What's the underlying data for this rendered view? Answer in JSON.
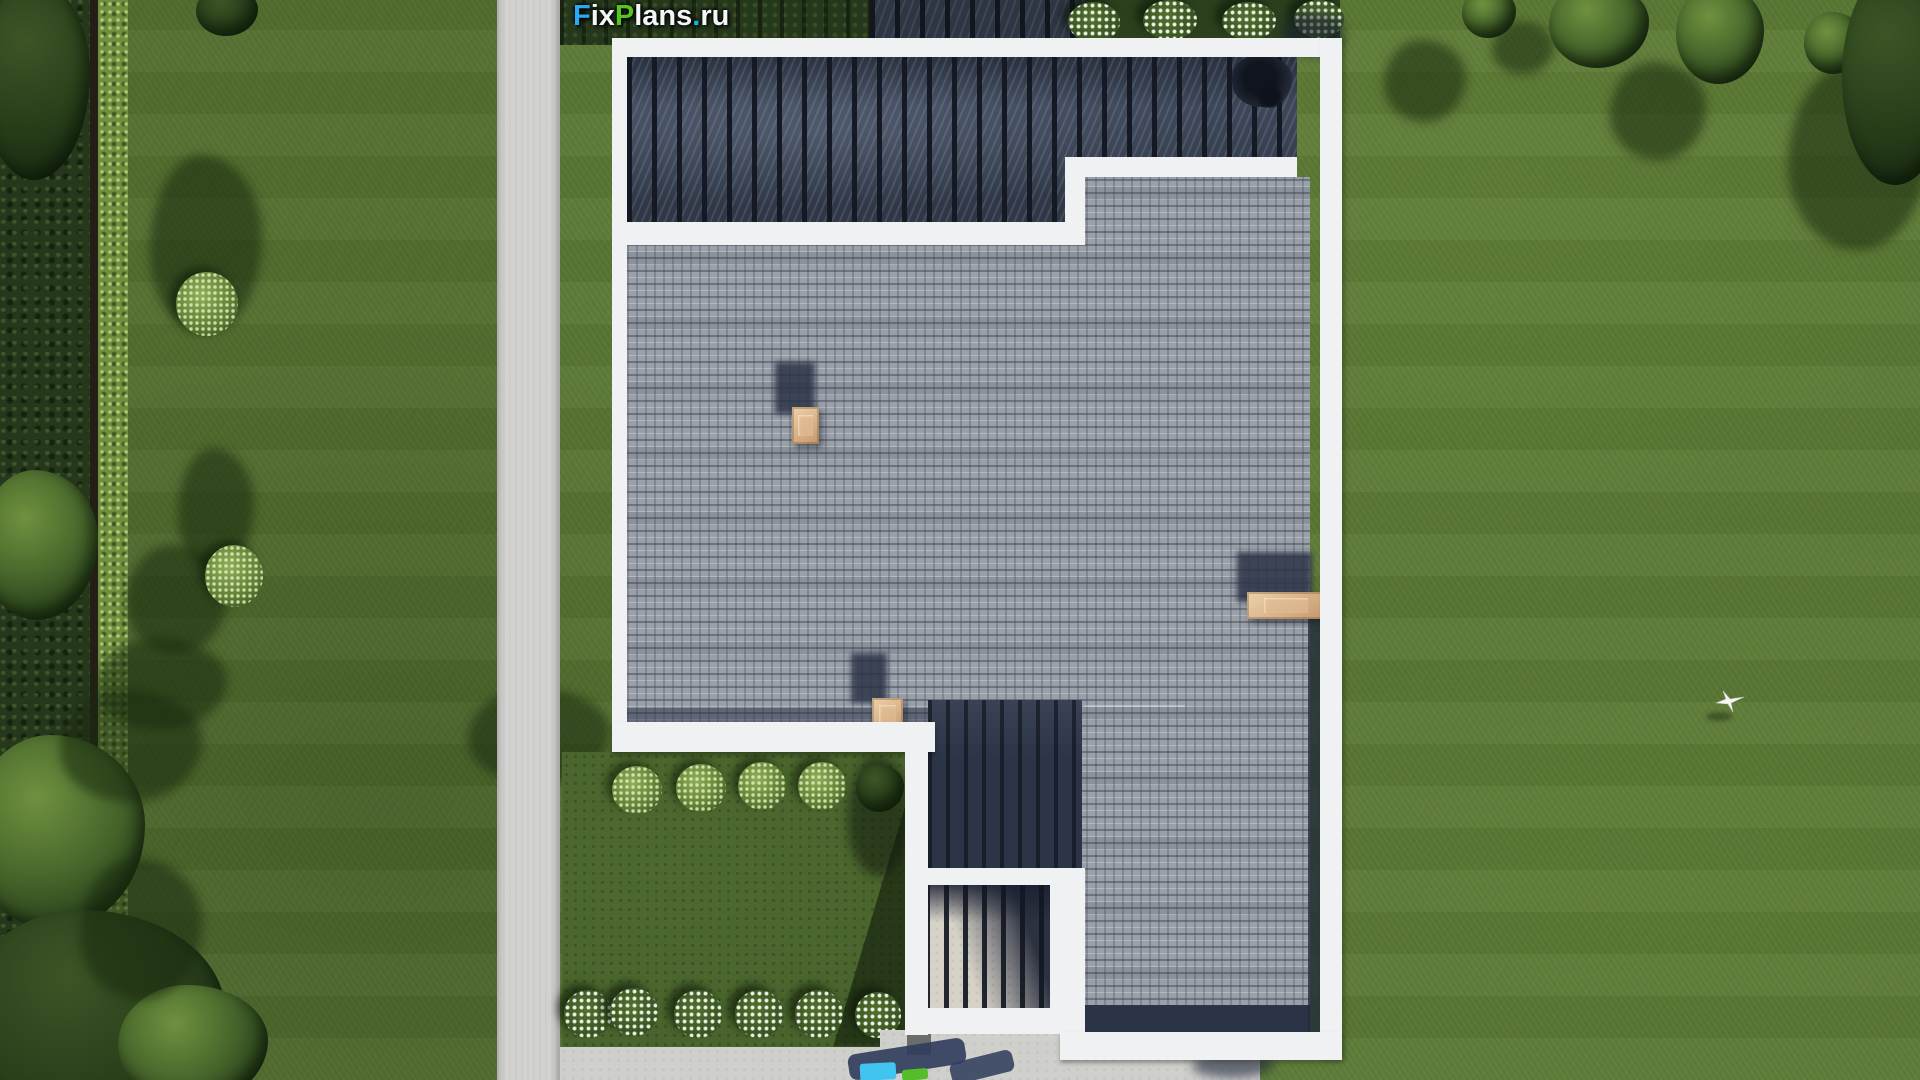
{
  "watermark": {
    "text": "FixPlans.ru",
    "segments": {
      "f": "F",
      "ix": "ix",
      "p": "P",
      "lans": "lans",
      "dot": ".",
      "ru": "ru"
    },
    "colors": {
      "f": "#2ea7f5",
      "p": "#54c61e",
      "dot": "#16b8d4",
      "rest": "#f4f5f6"
    }
  },
  "scene": {
    "description": "Aerial top-down 3D render of a modern flat-roof house plot: gray shingle roof, glass pergola with dark slats, entry porch, concrete garden path, lawns, hedges, trees and flower beds",
    "objects": {
      "house_roof": "flat roof with gray shingles and white parapet",
      "pergola": "glass canopy with dark wooden slats",
      "entry_porch": "slatted canopy over light stone porch",
      "chimney_count": 3,
      "garden_path": "concrete path, left side",
      "front_garden_bed": "enclosed bed with 5 green shrubs and 6 white flower bushes",
      "top_flower_bed": "4 white flowering shrubs along top parapet",
      "bird": "white bird flying over right lawn",
      "left_boundary": "dark hedge, fence line and bright trimmed hedge",
      "driveway_apron": "concrete apron at bottom with partially cropped watermark"
    },
    "colors": {
      "lawn": "#5c7a36",
      "garden_bed": "#48632c",
      "hedge_dark": "#26381c",
      "hedge_bright": "#6f8f3f",
      "path_gray": "#d2d3d1",
      "parapet_white": "#f0f1f3",
      "pergola_glass": "#3d4759",
      "slat_black": "#141924",
      "shingle_gray": "#9aa0a9",
      "shadow_navy": "#2b3347",
      "chimney_tan": "#d3a97f",
      "concrete": "#cfd0cc"
    }
  }
}
